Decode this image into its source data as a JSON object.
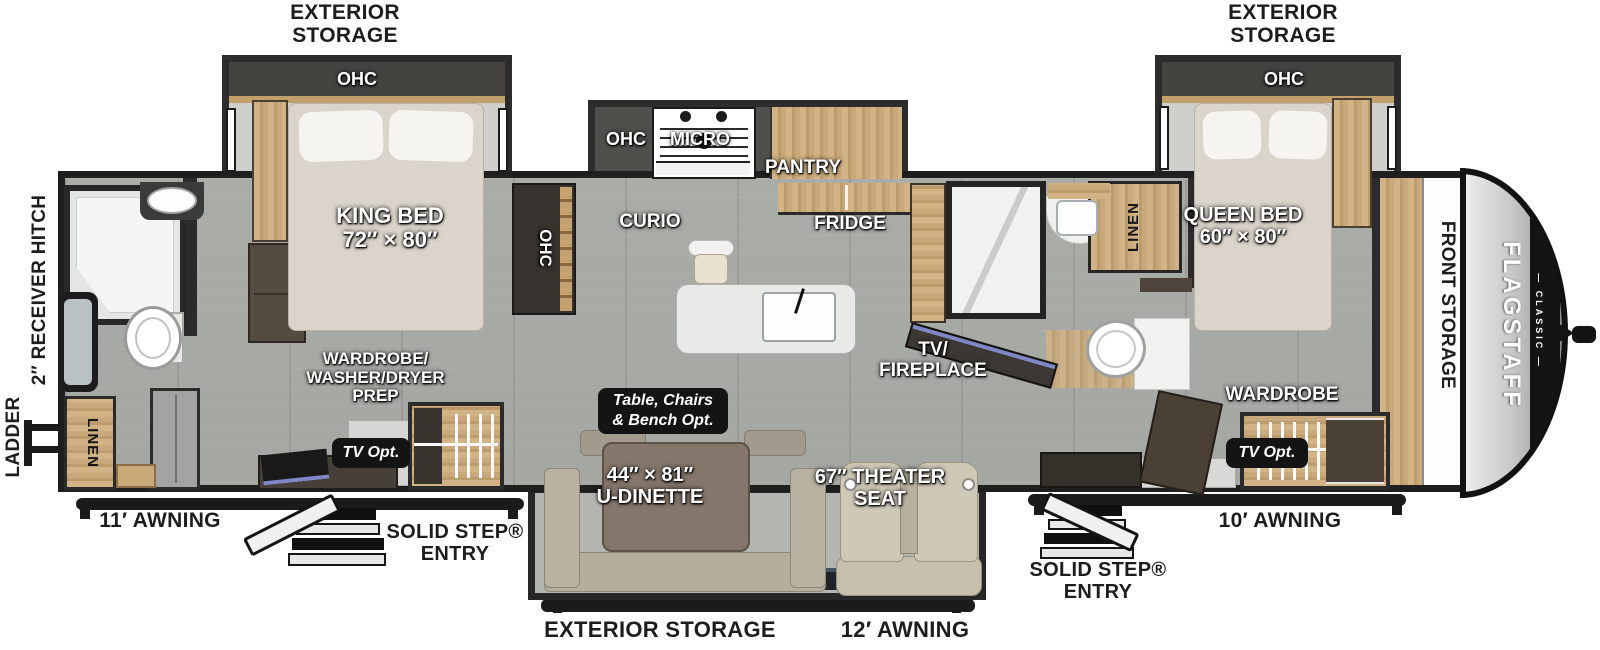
{
  "meta": {
    "title": "Flagstaff Classic travel trailer floor plan",
    "type": "rv-floorplan"
  },
  "colors": {
    "floor": "#a8aba6",
    "wall": "#2b2b2b",
    "wood": "#c9a97b",
    "badge_bg": "#141414",
    "accent_screen": "#8087c6",
    "label_dark": "#1d1d1d",
    "label_light": "#ffffff"
  },
  "brand": {
    "name": "FLAGSTAFF",
    "series_display": "— CLASSIC —"
  },
  "exterior": {
    "rear_slide_storage_l1": "EXTERIOR",
    "rear_slide_storage_l2": "STORAGE",
    "front_slide_storage_l1": "EXTERIOR",
    "front_slide_storage_l2": "STORAGE",
    "ladder": "LADDER",
    "receiver_hitch": "2″ RECEIVER HITCH",
    "awning_rear": "11′ AWNING",
    "awning_mid": "12′ AWNING",
    "awning_front": "10′ AWNING",
    "entry_rear_l1": "SOLID STEP®",
    "entry_rear_l2": "ENTRY",
    "entry_front_l1": "SOLID STEP®",
    "entry_front_l2": "ENTRY",
    "bottom_storage": "EXTERIOR STORAGE",
    "front_storage": "FRONT STORAGE"
  },
  "rear_bedroom": {
    "ohc": "OHC",
    "bed_name": "KING BED",
    "bed_size": "72″ × 80″",
    "wardrobe_l1": "WARDROBE/",
    "wardrobe_l2": "WASHER/DRYER",
    "wardrobe_l3": "PREP",
    "tv_opt": "TV Opt."
  },
  "rear_bath": {
    "linen": "LINEN"
  },
  "kitchen": {
    "ohc_cabinet": "OHC",
    "curio": "CURIO",
    "ohc": "OHC",
    "micro": "MICRO",
    "pantry": "PANTRY",
    "fridge": "FRIDGE"
  },
  "living": {
    "tv_fireplace_l1": "TV/",
    "tv_fireplace_l2": "FIREPLACE",
    "table_opt_l1": "Table, Chairs",
    "table_opt_l2": "& Bench  Opt.",
    "dinette_size": "44″ × 81″",
    "dinette_name": "U-DINETTE",
    "theater_l1": "67″ THEATER",
    "theater_l2": "SEAT"
  },
  "mid_bath": {
    "linen": "LINEN"
  },
  "front_bedroom": {
    "ohc": "OHC",
    "bed_name": "QUEEN BED",
    "bed_size": "60″ × 80″",
    "wardrobe": "WARDROBE",
    "tv_opt": "TV Opt."
  }
}
